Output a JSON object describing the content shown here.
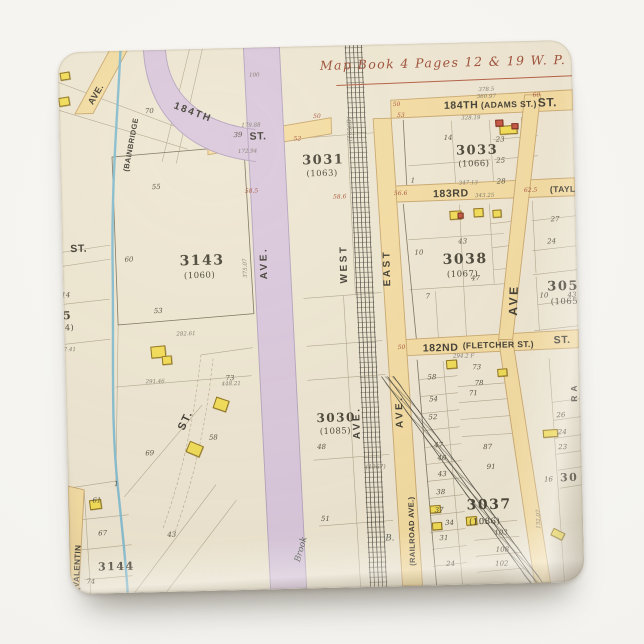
{
  "product": {
    "kind": "square map magnet photo",
    "background_color": "#f5f4f1"
  },
  "map": {
    "colors": {
      "paper": "#EFE7D2",
      "street_yellow": "#F5DCA0",
      "road_purple": "#D9C7DB",
      "water_blue": "#7FB9CD",
      "rail_dark": "#45423A",
      "title_red": "#9C4A31",
      "building_yellow": "#F2DC52",
      "building_red": "#C4523D"
    },
    "labels": [
      {
        "t": "Map Book 4  Pages 12 & 19 W. P.",
        "x": 262,
        "y": 14,
        "k": "title"
      },
      {
        "t": "184TH",
        "x": 385,
        "y": 58,
        "k": "st"
      },
      {
        "t": "(ADAMS ST.)",
        "x": 422,
        "y": 59,
        "k": "st2"
      },
      {
        "t": "ST.",
        "x": 479,
        "y": 56,
        "k": "st",
        "s": 12
      },
      {
        "t": "378.5",
        "x": 420,
        "y": 46,
        "k": "mg"
      },
      {
        "t": "360.97",
        "x": 418,
        "y": 53,
        "k": "mg"
      },
      {
        "t": "328.19",
        "x": 402,
        "y": 74,
        "k": "mg"
      },
      {
        "t": "50",
        "x": 334,
        "y": 58,
        "k": "mr"
      },
      {
        "t": "53",
        "x": 338,
        "y": 69,
        "k": "mr"
      },
      {
        "t": "60",
        "x": 474,
        "y": 52,
        "k": "mr"
      },
      {
        "t": "ST.",
        "x": 190,
        "y": 84,
        "k": "st"
      },
      {
        "t": "179.88",
        "x": 182,
        "y": 76,
        "k": "mg"
      },
      {
        "t": "172.94",
        "x": 178,
        "y": 102,
        "k": "mg"
      },
      {
        "t": "52",
        "x": 234,
        "y": 90,
        "k": "mr"
      },
      {
        "t": "50",
        "x": 254,
        "y": 68,
        "k": "mr"
      },
      {
        "t": "(1056B)",
        "x": 288,
        "y": 96,
        "k": "mg",
        "r": -90,
        "s": 6
      },
      {
        "t": "3031",
        "x": 242,
        "y": 108,
        "k": "blk"
      },
      {
        "t": "(1063)",
        "x": 246,
        "y": 124,
        "k": "old"
      },
      {
        "t": "3033",
        "x": 396,
        "y": 102,
        "k": "blk"
      },
      {
        "t": "(1066)",
        "x": 398,
        "y": 118,
        "k": "old"
      },
      {
        "t": "14",
        "x": 384,
        "y": 92,
        "k": "lot"
      },
      {
        "t": "23",
        "x": 436,
        "y": 95,
        "k": "lot"
      },
      {
        "t": "25",
        "x": 436,
        "y": 116,
        "k": "lot"
      },
      {
        "t": "28",
        "x": 436,
        "y": 137,
        "k": "lot"
      },
      {
        "t": "1",
        "x": 350,
        "y": 134,
        "k": "lot"
      },
      {
        "t": "183RD",
        "x": 372,
        "y": 146,
        "k": "st"
      },
      {
        "t": "56.6",
        "x": 333,
        "y": 147,
        "k": "mr"
      },
      {
        "t": "58.6",
        "x": 272,
        "y": 149,
        "k": "mr"
      },
      {
        "t": "58.5",
        "x": 184,
        "y": 141,
        "k": "mr"
      },
      {
        "t": "62.5",
        "x": 463,
        "y": 147,
        "k": "mr"
      },
      {
        "t": "(TAYLOR",
        "x": 489,
        "y": 145,
        "k": "st2"
      },
      {
        "t": "347.13",
        "x": 398,
        "y": 139,
        "k": "mg"
      },
      {
        "t": "343.25",
        "x": 414,
        "y": 152,
        "k": "mg"
      },
      {
        "t": "3038",
        "x": 380,
        "y": 210,
        "k": "blk",
        "s": 14
      },
      {
        "t": "(1067)",
        "x": 384,
        "y": 228,
        "k": "old"
      },
      {
        "t": "47",
        "x": 408,
        "y": 233,
        "k": "lot"
      },
      {
        "t": "10",
        "x": 352,
        "y": 206,
        "k": "lot"
      },
      {
        "t": "43",
        "x": 396,
        "y": 196,
        "k": "lot"
      },
      {
        "t": "7",
        "x": 362,
        "y": 250,
        "k": "lot"
      },
      {
        "t": "27",
        "x": 489,
        "y": 176,
        "k": "lot"
      },
      {
        "t": "24",
        "x": 485,
        "y": 198,
        "k": "lot"
      },
      {
        "t": "WEST",
        "x": 277,
        "y": 238,
        "k": "ave",
        "r": -90
      },
      {
        "t": "EAST",
        "x": 320,
        "y": 242,
        "k": "ave",
        "r": -90
      },
      {
        "t": "AVE.",
        "x": 197,
        "y": 232,
        "k": "ave",
        "r": -90
      },
      {
        "t": "184TH",
        "x": 117,
        "y": 52,
        "k": "st",
        "r": 22,
        "s": 10,
        "ls": 2
      },
      {
        "t": "AVE.",
        "x": 28,
        "y": 50,
        "k": "st2",
        "r": -58,
        "s": 9
      },
      {
        "t": "(BAINBRIDGE",
        "x": 62,
        "y": 120,
        "k": "st2",
        "r": -78,
        "s": 7.5
      },
      {
        "t": "70",
        "x": 86,
        "y": 58,
        "k": "lot"
      },
      {
        "t": "39",
        "x": 174,
        "y": 84,
        "k": "lot"
      },
      {
        "t": "3143",
        "x": 117,
        "y": 205,
        "k": "blk",
        "s": 14
      },
      {
        "t": "(1060)",
        "x": 121,
        "y": 223,
        "k": "old"
      },
      {
        "t": "53",
        "x": 90,
        "y": 258,
        "k": "lot"
      },
      {
        "t": "60",
        "x": 62,
        "y": 206,
        "k": "lot"
      },
      {
        "t": "55",
        "x": 91,
        "y": 134,
        "k": "lot"
      },
      {
        "t": "375.07",
        "x": 181,
        "y": 230,
        "k": "mg",
        "r": -90
      },
      {
        "t": "100",
        "x": 191,
        "y": 26,
        "k": "mg"
      },
      {
        "t": "282.61",
        "x": 112,
        "y": 283,
        "k": "mg"
      },
      {
        "t": "ST.",
        "x": 8,
        "y": 192,
        "k": "st"
      },
      {
        "t": "45",
        "x": -10,
        "y": 258,
        "k": "blk",
        "s": 11
      },
      {
        "t": "(984)",
        "x": -14,
        "y": 272,
        "k": "old",
        "s": 8
      },
      {
        "t": "14",
        "x": -2,
        "y": 240,
        "k": "lot"
      },
      {
        "t": "227.41",
        "x": -8,
        "y": 296,
        "k": "mg"
      },
      {
        "t": "ST.",
        "x": 110,
        "y": 378,
        "k": "st",
        "r": -63,
        "s": 11,
        "ls": 1.5
      },
      {
        "t": "291.46",
        "x": 80,
        "y": 330,
        "k": "mg"
      },
      {
        "t": "448.21",
        "x": 156,
        "y": 334,
        "k": "mg"
      },
      {
        "t": "73",
        "x": 160,
        "y": 327,
        "k": "lot"
      },
      {
        "t": "58",
        "x": 142,
        "y": 386,
        "k": "lot"
      },
      {
        "t": "69",
        "x": 78,
        "y": 400,
        "k": "lot"
      },
      {
        "t": "1",
        "x": 46,
        "y": 430,
        "k": "lot"
      },
      {
        "t": "3030",
        "x": 250,
        "y": 366,
        "k": "blk",
        "s": 12
      },
      {
        "t": "(1085)",
        "x": 253,
        "y": 382,
        "k": "old"
      },
      {
        "t": "48",
        "x": 250,
        "y": 398,
        "k": "lot"
      },
      {
        "t": "AVE.",
        "x": 286,
        "y": 394,
        "k": "ave",
        "r": -90
      },
      {
        "t": "AVE.",
        "x": 329,
        "y": 384,
        "k": "ave",
        "r": -90
      },
      {
        "t": "AVE",
        "x": 443,
        "y": 274,
        "k": "ave",
        "r": -87,
        "s": 12
      },
      {
        "t": "(RAILROAD AVE.)",
        "x": 339,
        "y": 522,
        "k": "st2",
        "r": -90,
        "s": 7.5
      },
      {
        "t": "182ND",
        "x": 358,
        "y": 300,
        "k": "st"
      },
      {
        "t": "(FLETCHER ST.)",
        "x": 398,
        "y": 299,
        "k": "st2"
      },
      {
        "t": "50",
        "x": 333,
        "y": 301,
        "k": "mr"
      },
      {
        "t": "294.2 F",
        "x": 388,
        "y": 312,
        "k": "mg"
      },
      {
        "t": "ST.",
        "x": 489,
        "y": 295,
        "k": "st"
      },
      {
        "t": "RA",
        "x": 504,
        "y": 362,
        "k": "st2",
        "r": -90,
        "ls": 4
      },
      {
        "t": "3050",
        "x": 484,
        "y": 240,
        "k": "blk"
      },
      {
        "t": "(1065)",
        "x": 487,
        "y": 258,
        "k": "old"
      },
      {
        "t": "10",
        "x": 476,
        "y": 252,
        "k": "lot"
      },
      {
        "t": "43",
        "x": 504,
        "y": 252,
        "k": "lot"
      },
      {
        "t": "3037",
        "x": 398,
        "y": 456,
        "k": "blk",
        "s": 14
      },
      {
        "t": "(1086)",
        "x": 400,
        "y": 476,
        "k": "old"
      },
      {
        "t": "58",
        "x": 362,
        "y": 331,
        "k": "lot"
      },
      {
        "t": "54",
        "x": 363,
        "y": 353,
        "k": "lot"
      },
      {
        "t": "52",
        "x": 362,
        "y": 371,
        "k": "lot"
      },
      {
        "t": "47",
        "x": 367,
        "y": 399,
        "k": "lot"
      },
      {
        "t": "46",
        "x": 370,
        "y": 412,
        "k": "lot"
      },
      {
        "t": "43",
        "x": 370,
        "y": 428,
        "k": "lot"
      },
      {
        "t": "38",
        "x": 368,
        "y": 446,
        "k": "lot"
      },
      {
        "t": "37",
        "x": 366,
        "y": 464,
        "k": "lot"
      },
      {
        "t": "34",
        "x": 376,
        "y": 477,
        "k": "lot"
      },
      {
        "t": "31",
        "x": 370,
        "y": 492,
        "k": "lot"
      },
      {
        "t": "24",
        "x": 376,
        "y": 518,
        "k": "lot"
      },
      {
        "t": "73",
        "x": 407,
        "y": 322,
        "k": "lot"
      },
      {
        "t": "78",
        "x": 409,
        "y": 338,
        "k": "lot"
      },
      {
        "t": "71",
        "x": 403,
        "y": 348,
        "k": "lot"
      },
      {
        "t": "87",
        "x": 416,
        "y": 402,
        "k": "lot"
      },
      {
        "t": "91",
        "x": 419,
        "y": 422,
        "k": "lot"
      },
      {
        "t": "103",
        "x": 425,
        "y": 488,
        "k": "lot"
      },
      {
        "t": "108",
        "x": 426,
        "y": 505,
        "k": "lot"
      },
      {
        "t": "102",
        "x": 425,
        "y": 519,
        "k": "lot"
      },
      {
        "t": "(1067)",
        "x": 298,
        "y": 420,
        "k": "mg",
        "s": 6
      },
      {
        "t": "132.07",
        "x": 468,
        "y": 488,
        "k": "mg",
        "r": -90
      },
      {
        "t": "Brook",
        "x": 224,
        "y": 514,
        "k": "brk",
        "r": -73
      },
      {
        "t": "B.",
        "x": 316,
        "y": 490,
        "k": "brk"
      },
      {
        "t": "51",
        "x": 252,
        "y": 470,
        "k": "lot"
      },
      {
        "t": "(VALENTIN",
        "x": 2,
        "y": 538,
        "k": "st2",
        "r": -86,
        "s": 8
      },
      {
        "t": "3144",
        "x": 28,
        "y": 510,
        "k": "blk",
        "s": 11
      },
      {
        "t": "61",
        "x": 24,
        "y": 446,
        "k": "lot"
      },
      {
        "t": "67",
        "x": 29,
        "y": 479,
        "k": "lot"
      },
      {
        "t": "74",
        "x": 16,
        "y": 527,
        "k": "lot"
      },
      {
        "t": "43",
        "x": 98,
        "y": 482,
        "k": "lot"
      },
      {
        "t": "26",
        "x": 490,
        "y": 372,
        "k": "lot"
      },
      {
        "t": "24",
        "x": 491,
        "y": 389,
        "k": "lot"
      },
      {
        "t": "23",
        "x": 491,
        "y": 404,
        "k": "lot"
      },
      {
        "t": "16",
        "x": 476,
        "y": 436,
        "k": "lot"
      },
      {
        "t": "30",
        "x": 492,
        "y": 432,
        "k": "blk",
        "s": 11
      }
    ],
    "buildings": [
      {
        "x": 2,
        "y": 20,
        "w": 8,
        "h": 6,
        "c": "y",
        "r": -8
      },
      {
        "x": 0,
        "y": 45,
        "w": 9,
        "h": 7,
        "c": "y",
        "r": -8
      },
      {
        "x": 86,
        "y": 296,
        "w": 13,
        "h": 10,
        "c": "y",
        "r": -4
      },
      {
        "x": 97,
        "y": 306,
        "w": 8,
        "h": 7,
        "c": "y",
        "r": -4
      },
      {
        "x": 148,
        "y": 350,
        "w": 12,
        "h": 10,
        "c": "y",
        "r": 20
      },
      {
        "x": 120,
        "y": 394,
        "w": 13,
        "h": 10,
        "c": "y",
        "r": 24
      },
      {
        "x": 21,
        "y": 448,
        "w": 10,
        "h": 8,
        "c": "y",
        "r": -6
      },
      {
        "x": 388,
        "y": 168,
        "w": 10,
        "h": 7,
        "c": "y",
        "r": -2
      },
      {
        "x": 412,
        "y": 166,
        "w": 8,
        "h": 7,
        "c": "y",
        "r": -2
      },
      {
        "x": 431,
        "y": 168,
        "w": 7,
        "h": 6,
        "c": "y",
        "r": -2
      },
      {
        "x": 440,
        "y": 84,
        "w": 16,
        "h": 7,
        "c": "y",
        "r": -2
      },
      {
        "x": 436,
        "y": 78,
        "w": 6,
        "h": 5,
        "c": "r",
        "r": -2
      },
      {
        "x": 452,
        "y": 82,
        "w": 5,
        "h": 4,
        "c": "r",
        "r": 0
      },
      {
        "x": 396,
        "y": 170,
        "w": 4,
        "h": 4,
        "c": "r",
        "r": 0
      },
      {
        "x": 381,
        "y": 317,
        "w": 9,
        "h": 7,
        "c": "y",
        "r": -3
      },
      {
        "x": 432,
        "y": 327,
        "w": 8,
        "h": 6,
        "c": "y",
        "r": -3
      },
      {
        "x": 361,
        "y": 462,
        "w": 9,
        "h": 6,
        "c": "y",
        "r": -3
      },
      {
        "x": 363,
        "y": 479,
        "w": 8,
        "h": 6,
        "c": "y",
        "r": -3
      },
      {
        "x": 397,
        "y": 474,
        "w": 9,
        "h": 7,
        "c": "y",
        "r": -3
      },
      {
        "x": 476,
        "y": 389,
        "w": 13,
        "h": 6,
        "c": "y",
        "r": -3
      },
      {
        "x": 482,
        "y": 490,
        "w": 11,
        "h": 6,
        "c": "y",
        "r": 28
      }
    ]
  }
}
